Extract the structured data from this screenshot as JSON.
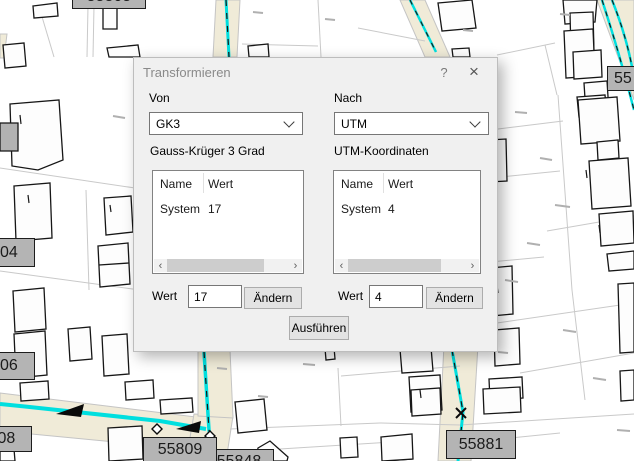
{
  "map": {
    "colors": {
      "road_fill": "#f0ebd8",
      "stream": "#00dfdf",
      "parcel_line": "#c9c9c9",
      "label_bg": "#b4b4b4",
      "building_outline": "#161616"
    },
    "labels": [
      {
        "id": "top-edge",
        "text": "55805"
      },
      {
        "id": "left-upper",
        "text": "55804"
      },
      {
        "id": "left-middle",
        "text": "55806"
      },
      {
        "id": "left-lower",
        "text": "55808"
      },
      {
        "id": "bottom-left",
        "text": "55809"
      },
      {
        "id": "bottom-left-2",
        "text": "55848"
      },
      {
        "id": "bottom-right",
        "text": "55881"
      },
      {
        "id": "right-upper",
        "text": "55"
      }
    ]
  },
  "dialog": {
    "title": "Transformieren",
    "help_icon": "?",
    "close_icon": "×",
    "from_label": "Von",
    "from_value": "GK3",
    "to_label": "Nach",
    "to_value": "UTM",
    "left_group": {
      "heading": "Gauss-Krüger 3 Grad",
      "col_name": "Name",
      "col_value": "Wert",
      "row_name": "System",
      "row_value": "17",
      "scroll_left": "‹",
      "scroll_right": "›",
      "value_label": "Wert",
      "value_input": "17",
      "change_button": "Ändern"
    },
    "right_group": {
      "heading": "UTM-Koordinaten",
      "col_name": "Name",
      "col_value": "Wert",
      "row_name": "System",
      "row_value": "4",
      "scroll_left": "‹",
      "scroll_right": "›",
      "value_label": "Wert",
      "value_input": "4",
      "change_button": "Ändern"
    },
    "execute_button": "Ausführen"
  }
}
